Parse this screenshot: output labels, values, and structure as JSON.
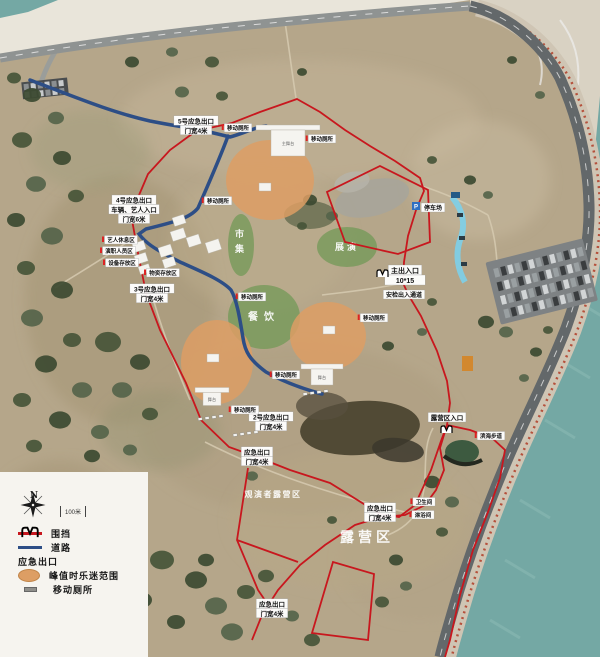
{
  "legend": {
    "north": "N",
    "scale": "100米",
    "items": [
      {
        "id": "fence",
        "label": "围挡",
        "color": "#c8171e"
      },
      {
        "id": "road",
        "label": "道路",
        "color": "#2d4e86"
      },
      {
        "id": "emergency-exit",
        "label": "应急出口"
      },
      {
        "id": "fan-range",
        "label": "峰值时乐迷范围",
        "color": "#dd9e64"
      },
      {
        "id": "mobile-toilet",
        "label": "移动厕所",
        "color": "#8f8f8b"
      }
    ]
  },
  "zones": {
    "fan_color": "#dd9e64",
    "green_color": "#6f9954",
    "fan": [
      {
        "cx": 270,
        "cy": 180,
        "rx": 44,
        "ry": 40
      },
      {
        "cx": 217,
        "cy": 362,
        "rx": 36,
        "ry": 42
      },
      {
        "cx": 328,
        "cy": 336,
        "rx": 38,
        "ry": 34
      }
    ],
    "green": [
      {
        "cx": 241,
        "cy": 245,
        "rx": 13,
        "ry": 31,
        "label": "市集",
        "vertical": true
      },
      {
        "cx": 347,
        "cy": 247,
        "rx": 30,
        "ry": 20,
        "label": "展演",
        "vertical": false
      },
      {
        "cx": 264,
        "cy": 317,
        "rx": 36,
        "ry": 32,
        "label": "餐饮",
        "vertical": false
      }
    ]
  },
  "stages": [
    {
      "id": "main-stage",
      "label": "主舞台",
      "x": 288,
      "y": 143,
      "w": 34,
      "h": 26,
      "wing": 64
    },
    {
      "id": "stage-2",
      "label": "舞台",
      "x": 322,
      "y": 377,
      "w": 22,
      "h": 16,
      "wing": 42
    },
    {
      "id": "stage-3",
      "label": "舞台",
      "x": 212,
      "y": 399,
      "w": 18,
      "h": 13,
      "wing": 34
    }
  ],
  "control_points": [
    {
      "x": 265,
      "y": 187
    },
    {
      "x": 213,
      "y": 358
    },
    {
      "x": 329,
      "y": 330
    }
  ],
  "labels": [
    {
      "id": "exit-5-label",
      "kind": "box",
      "lines": [
        "5号应急出口",
        "门宽4米"
      ],
      "x": 196,
      "y": 127,
      "fs": 6.5
    },
    {
      "id": "exit-4-label",
      "kind": "box",
      "lines": [
        "4号应急出口",
        "车辆、艺人入口",
        "门宽6米"
      ],
      "x": 134,
      "y": 211,
      "fs": 6.5
    },
    {
      "id": "exit-3-label",
      "kind": "box",
      "lines": [
        "3号应急出口",
        "门宽4米"
      ],
      "x": 152,
      "y": 295,
      "fs": 6.5
    },
    {
      "id": "exit-2-label",
      "kind": "box",
      "lines": [
        "2号应急出口",
        "门宽4米"
      ],
      "x": 271,
      "y": 423,
      "fs": 6.5
    },
    {
      "id": "exit-south-label",
      "kind": "box",
      "lines": [
        "应急出口",
        "门宽4米"
      ],
      "x": 257,
      "y": 458,
      "fs": 6.5
    },
    {
      "id": "exit-camp-label",
      "kind": "box",
      "lines": [
        "应急出口",
        "门宽4米"
      ],
      "x": 380,
      "y": 514,
      "fs": 6.5
    },
    {
      "id": "exit-bottom-label",
      "kind": "box",
      "lines": [
        "应急出口",
        "门宽4米"
      ],
      "x": 272,
      "y": 610,
      "fs": 6.5
    },
    {
      "id": "main-entrance-label",
      "kind": "box",
      "icon": "exit",
      "lines": [
        "主出入口",
        "10*15"
      ],
      "x": 405,
      "y": 277,
      "fs": 7
    },
    {
      "id": "security-channel-label",
      "kind": "box",
      "lines": [
        "安检出入通道"
      ],
      "x": 404,
      "y": 296,
      "fs": 6
    },
    {
      "id": "camp-entrance-label",
      "kind": "box",
      "icon": "exit-below",
      "lines": [
        "露营区入口"
      ],
      "x": 447,
      "y": 419,
      "fs": 6.5
    },
    {
      "id": "camping-area-label",
      "kind": "big",
      "lines": [
        "露营区"
      ],
      "x": 367,
      "y": 542,
      "fs": 14
    },
    {
      "id": "camping-sub-label",
      "kind": "big",
      "lines": [
        "观演者露营区"
      ],
      "x": 273,
      "y": 497,
      "fs": 8
    },
    {
      "id": "parking-label",
      "kind": "box",
      "icon": "parking",
      "lines": [
        "停车场"
      ],
      "x": 433,
      "y": 209,
      "fs": 6
    },
    {
      "id": "toilet-label-1",
      "kind": "tiny",
      "lines": [
        "移动厕所"
      ],
      "x": 218,
      "y": 202,
      "fs": 5.5
    },
    {
      "id": "toilet-label-2",
      "kind": "tiny",
      "lines": [
        "移动厕所"
      ],
      "x": 252,
      "y": 298,
      "fs": 5.5
    },
    {
      "id": "toilet-label-3",
      "kind": "tiny",
      "lines": [
        "移动厕所"
      ],
      "x": 374,
      "y": 319,
      "fs": 5.5
    },
    {
      "id": "toilet-label-4",
      "kind": "tiny",
      "lines": [
        "移动厕所"
      ],
      "x": 245,
      "y": 411,
      "fs": 5.5
    },
    {
      "id": "toilet-label-5",
      "kind": "tiny",
      "lines": [
        "移动厕所"
      ],
      "x": 286,
      "y": 376,
      "fs": 5.5
    },
    {
      "id": "toilet-label-6",
      "kind": "tiny",
      "lines": [
        "移动厕所"
      ],
      "x": 322,
      "y": 140,
      "fs": 5.5
    },
    {
      "id": "toilet-label-7",
      "kind": "tiny",
      "lines": [
        "移动厕所"
      ],
      "x": 238,
      "y": 129,
      "fs": 5.5
    },
    {
      "id": "backstage-label-1",
      "kind": "tiny",
      "lines": [
        "艺人休息区"
      ],
      "x": 121,
      "y": 241,
      "fs": 5.5
    },
    {
      "id": "backstage-label-2",
      "kind": "tiny",
      "lines": [
        "演职人员区"
      ],
      "x": 119,
      "y": 252,
      "fs": 5.5
    },
    {
      "id": "backstage-label-3",
      "kind": "tiny",
      "lines": [
        "设备存放区"
      ],
      "x": 122,
      "y": 264,
      "fs": 5.5
    },
    {
      "id": "backstage-label-4",
      "kind": "tiny",
      "lines": [
        "物资存放区"
      ],
      "x": 163,
      "y": 274,
      "fs": 5.5
    },
    {
      "id": "camp-facility-label-1",
      "kind": "tiny",
      "lines": [
        "卫生间"
      ],
      "x": 424,
      "y": 503,
      "fs": 5.5
    },
    {
      "id": "camp-facility-label-2",
      "kind": "tiny",
      "lines": [
        "淋浴间"
      ],
      "x": 423,
      "y": 516,
      "fs": 5.5
    },
    {
      "id": "coast-path-label",
      "kind": "tiny",
      "lines": [
        "滨海步道"
      ],
      "x": 491,
      "y": 437,
      "fs": 5.5
    }
  ],
  "toilet_rows": [
    {
      "x": 198,
      "y": 418
    },
    {
      "x": 303,
      "y": 393
    },
    {
      "x": 233,
      "y": 434
    }
  ]
}
